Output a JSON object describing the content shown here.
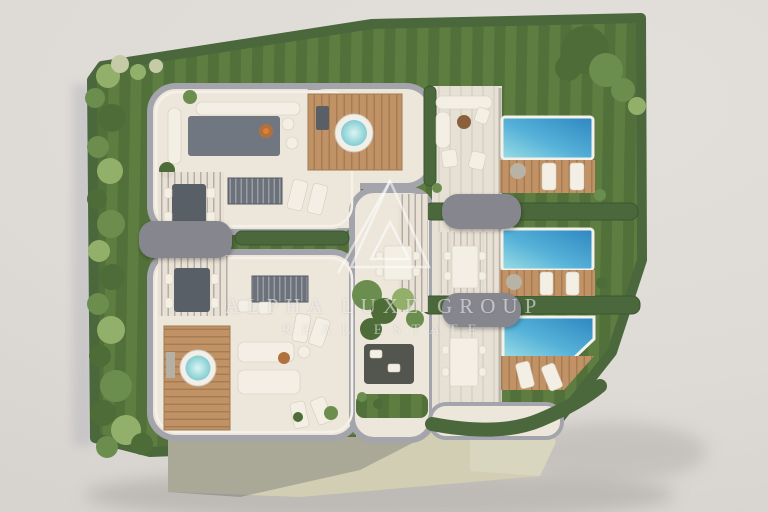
{
  "watermark": {
    "logo_icon": "alpha-triangle-logo-icon",
    "line1": "ALPHA LUXE GROUP",
    "line2": "REAL ESTATE"
  },
  "site_features": {
    "rooftop_terraces": 2,
    "rooftop_hot_tubs": 2,
    "garden_units_with_pools": 3,
    "unit_label_badges": 3,
    "badge_labels": [
      "",
      "",
      ""
    ]
  },
  "scene": {
    "palette": {
      "background": "#dedad6",
      "lawn_light": "#5d7d41",
      "lawn_dark": "#52703a",
      "hedge": "#4a683c",
      "hedge_dark": "#3b5630",
      "tree_light": "#93b06b",
      "tree_mid": "#6b8e4e",
      "tree_dark": "#4e6c38",
      "pool_shallow": "#9adde4",
      "pool_mid": "#55b1d8",
      "pool_deep": "#2e86c0",
      "wood": "#c09266",
      "wood_dark": "#a87c52",
      "floor": "#ece6db",
      "floor_column": "#e7e0d4",
      "parapet": "#a4a4ac",
      "parapet_light": "#f6f1e8",
      "badge": "#86868e",
      "facade": "#d2ceb3",
      "rug": "#666e79",
      "furniture_white": "#f3efe5",
      "furniture_dark": "#595f66",
      "jacuzzi_water": "#82cdd3",
      "watermark": "rgba(250,250,248,0.55)"
    }
  }
}
